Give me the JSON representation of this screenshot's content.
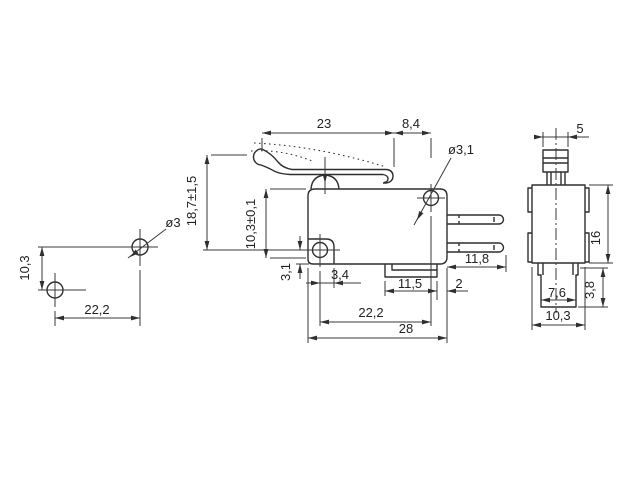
{
  "meta": {
    "drawing_type": "technical dimensional drawing, lever microswitch, three views",
    "units_style": "millimetres with comma decimals",
    "line_color": "#2f2f2f",
    "background": "#ffffff"
  },
  "views": {
    "mounting_holes": {
      "hole_diameter": "ø3",
      "vertical_pitch": "10,3",
      "horizontal_pitch": "22,2"
    },
    "front": {
      "lever_length": "23",
      "lever_rear": "8,4",
      "corner_hole_diameter": "ø3,1",
      "free_position_height": "18,7±1,5",
      "body_height_ref": "10,3±0,1",
      "hole_to_bottom": "3,1",
      "hole_to_step": "3,4",
      "bottom_tab_length": "11,5",
      "bottom_tab_gap": "2",
      "hole_pitch": "22,2",
      "body_length": "28",
      "terminal_length": "11,8"
    },
    "side": {
      "plunger_width": "5",
      "body_height": "16",
      "bottom_terminal_height": "3,8",
      "bottom_terminal_width": "7,6",
      "body_width": "10,3"
    }
  }
}
